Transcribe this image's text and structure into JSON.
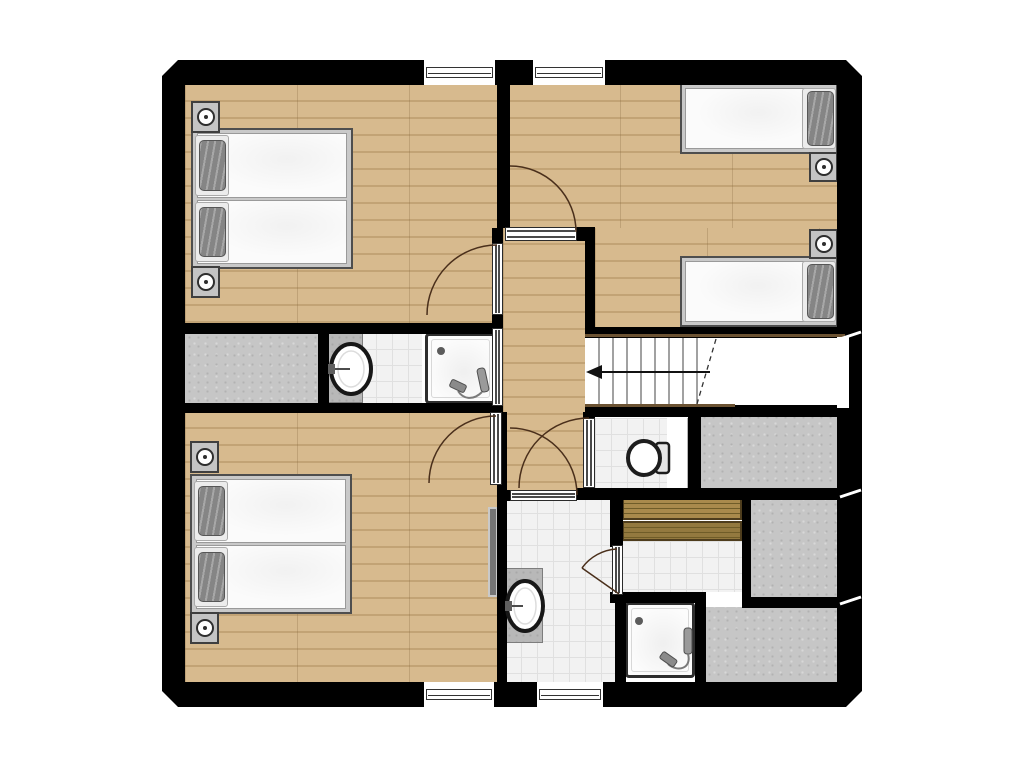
{
  "plan": {
    "type": "architectural-floor-plan",
    "storeys_shown": 1,
    "rooms": [
      {
        "id": "bedroom-top-left",
        "floor": "wood",
        "fixtures": [
          "double-bed",
          "nightstand-with-lamp",
          "nightstand-with-lamp"
        ],
        "windows": 1,
        "doors": 1
      },
      {
        "id": "bedroom-top-right",
        "floor": "wood",
        "fixtures": [
          "single-bed",
          "single-bed",
          "nightstand-with-lamp",
          "nightstand-with-lamp"
        ],
        "windows": 1,
        "doors": 1
      },
      {
        "id": "bedroom-bottom-left",
        "floor": "wood",
        "fixtures": [
          "double-bed",
          "nightstand-with-lamp",
          "nightstand-with-lamp",
          "radiator"
        ],
        "windows": 1,
        "doors": 1
      },
      {
        "id": "hallway-landing",
        "floor": "wood",
        "fixtures": [],
        "windows": 0,
        "doors": 5
      },
      {
        "id": "storage-left",
        "floor": "speckled-gray",
        "fixtures": [],
        "windows": 0,
        "doors": 0
      },
      {
        "id": "bathroom-middle-left",
        "floor": "tile",
        "fixtures": [
          "washbasin",
          "vanity-counter",
          "shower-tray-with-hand-shower"
        ],
        "windows": 0,
        "doors": 1
      },
      {
        "id": "staircase",
        "floor": "white",
        "fixtures": [
          "treads",
          "break-line",
          "direction-arrow"
        ],
        "windows": 0,
        "doors": 0
      },
      {
        "id": "wc",
        "floor": "tile",
        "fixtures": [
          "toilet-with-cistern"
        ],
        "windows": 0,
        "doors": 1
      },
      {
        "id": "bathroom-bottom-center",
        "floor": "tile",
        "fixtures": [
          "washbasin",
          "vanity-counter"
        ],
        "windows": 1,
        "doors": 2
      },
      {
        "id": "sauna",
        "floor": "tile",
        "fixtures": [
          "bench-upper",
          "bench-lower"
        ],
        "windows": 0,
        "doors": 1
      },
      {
        "id": "shower-stall-bottom",
        "floor": "tray",
        "fixtures": [
          "shower-tray-with-hand-shower"
        ],
        "windows": 0,
        "doors": 0
      },
      {
        "id": "storage-right-top",
        "floor": "speckled-gray",
        "fixtures": [],
        "windows": 0,
        "doors": 0
      },
      {
        "id": "storage-right-middle",
        "floor": "speckled-gray",
        "fixtures": [],
        "windows": 0,
        "doors": 0
      },
      {
        "id": "storage-right-bottom",
        "floor": "speckled-gray",
        "fixtures": [],
        "windows": 0,
        "doors": 0
      }
    ],
    "stairs": {
      "riser_lines": 8,
      "arrow_direction": "left",
      "break_line": "dashed-diagonal"
    },
    "openings": {
      "windows_total": 4,
      "door_swings_total": 6,
      "door_frames_total": 7
    }
  },
  "colors": {
    "wall": "#000000",
    "wood": "#d7ba8e",
    "wood_line": "#c2a375",
    "tile": "#f2f2f2",
    "tile_line": "#e0e0e0",
    "gray": "#c6c6c6",
    "gray_speckle": "#b2b2b2",
    "bench": "#a98a4c",
    "bench_dark": "#93793f",
    "bench_line": "#6f5c28",
    "counter": "#b8b8b8",
    "bedframe": "#c9c9c9",
    "mattress": "#fbfbfb",
    "pillow": "#858585",
    "radiator": "#757575",
    "stair_edge": "#6b5232",
    "arc": "#4a2f1b"
  }
}
